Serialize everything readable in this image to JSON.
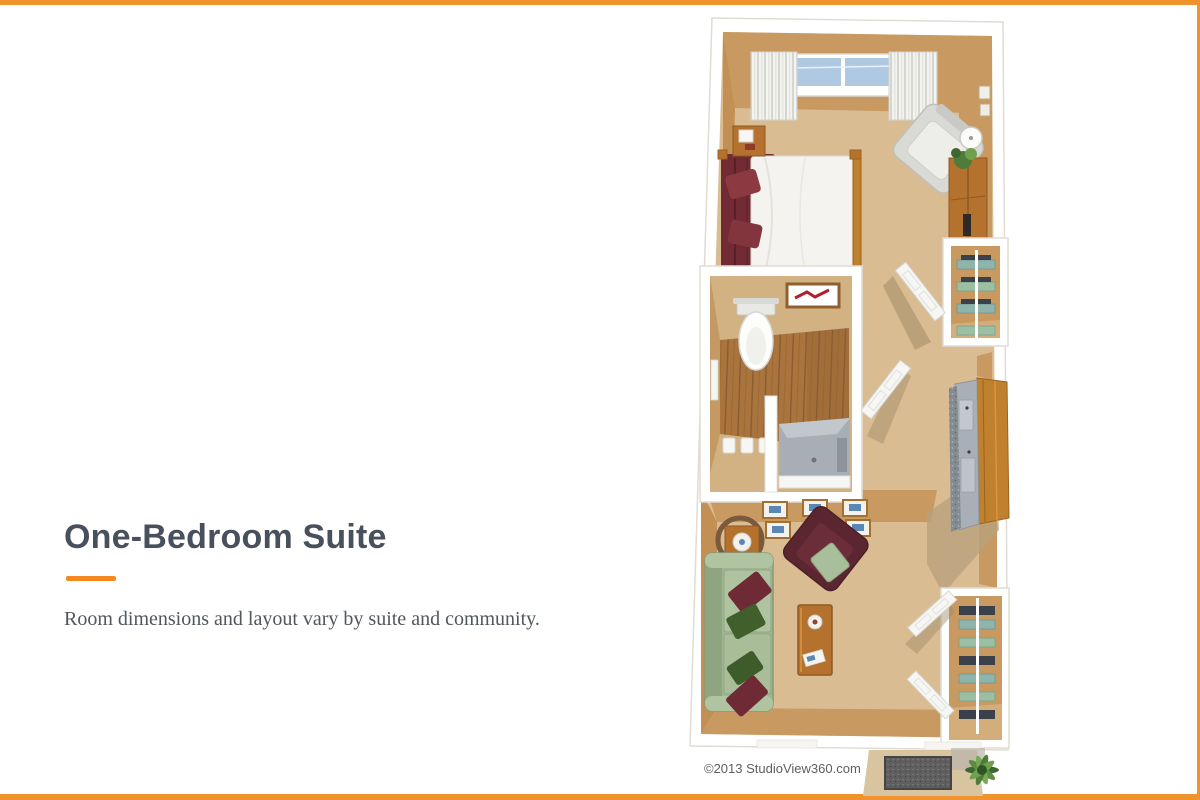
{
  "theme": {
    "frame_border_color": "#F0922D",
    "accent_color": "#F6891E",
    "title_color": "#47505C",
    "subtitle_color": "#50575D",
    "copyright_color": "#5E5E5E",
    "background": "#FFFFFF"
  },
  "panel": {
    "title": "One-Bedroom Suite",
    "subtitle": "Room dimensions and layout vary by suite and community."
  },
  "floorplan": {
    "copyright": "©2013 StudioView360.com",
    "colors": {
      "wall": "#FFFFFF",
      "wall_outline": "#E0DCD4",
      "carpet": "#D9BC92",
      "wall_face": "#C89A62",
      "wall_face_dark": "#C28F55",
      "shadow": "#B7A07C",
      "wood_floor": "#A9743E",
      "wood_furniture": "#C0812F",
      "bedspread_maroon": "#722B35",
      "armchair_maroon": "#5C2630",
      "sofa_green": "#A9BE9B",
      "pillow_green_dark": "#405F2B",
      "lounge_chair_gray": "#D9D9D6",
      "counter_gray": "#A9AFB6",
      "granite_gray": "#858B92",
      "towel_teal": "#8FB4AC",
      "shelf_item_dark": "#3A414B",
      "window_glass": "#AFC9E2",
      "plant_green": "#4F7C3A",
      "doormat_gray": "#5F5F5F",
      "entry_pad_tan": "#D8C49E",
      "art_red": "#B3202A",
      "art_blue": "#5B87B5"
    }
  }
}
